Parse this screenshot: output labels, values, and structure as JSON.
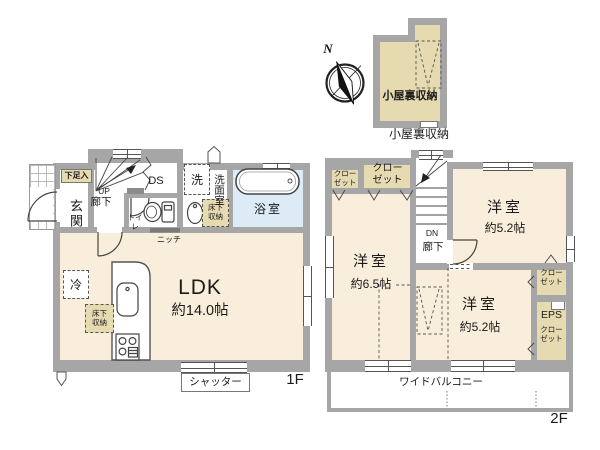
{
  "compass": {
    "north": "N"
  },
  "attic": {
    "room": "小屋裏収納",
    "caption": "小屋裏収納"
  },
  "floor1": {
    "label": "1F",
    "entrance": "玄関",
    "shoe_storage": "下足入",
    "up": "UP",
    "hallway": "廊下",
    "duct_space": "DS",
    "toilet": "トイレ",
    "washer": "洗",
    "washroom": "洗面室",
    "underfloor_storage": "床下\n収納",
    "bathroom": "浴室",
    "niche": "ニッチ",
    "ldk_name": "LDK",
    "ldk_size": "約14.0帖",
    "fridge": "冷",
    "underfloor_storage2": "床下\n収納",
    "shutter": "シャッター"
  },
  "floor2": {
    "label": "2F",
    "closet_nw_small": "クロー\nゼット",
    "closet_nw_large": "クロー\nゼット",
    "down": "DN",
    "hallway": "廊下",
    "room_ne_name": "洋室",
    "room_ne_size": "約5.2帖",
    "room_w_name": "洋室",
    "room_w_size": "約6.5帖",
    "room_se_name": "洋室",
    "room_se_size": "約5.2帖",
    "closet_ne": "クロー\nゼット",
    "eps": "EPS",
    "closet_se": "クロー\nゼット",
    "balcony": "ワイドバルコニー"
  },
  "colors": {
    "wall": "#a6a6a6",
    "room_cream": "#f9eedb",
    "bath_blue": "#dcebf5",
    "closet_tan": "#e6dab0",
    "line": "#444444"
  }
}
